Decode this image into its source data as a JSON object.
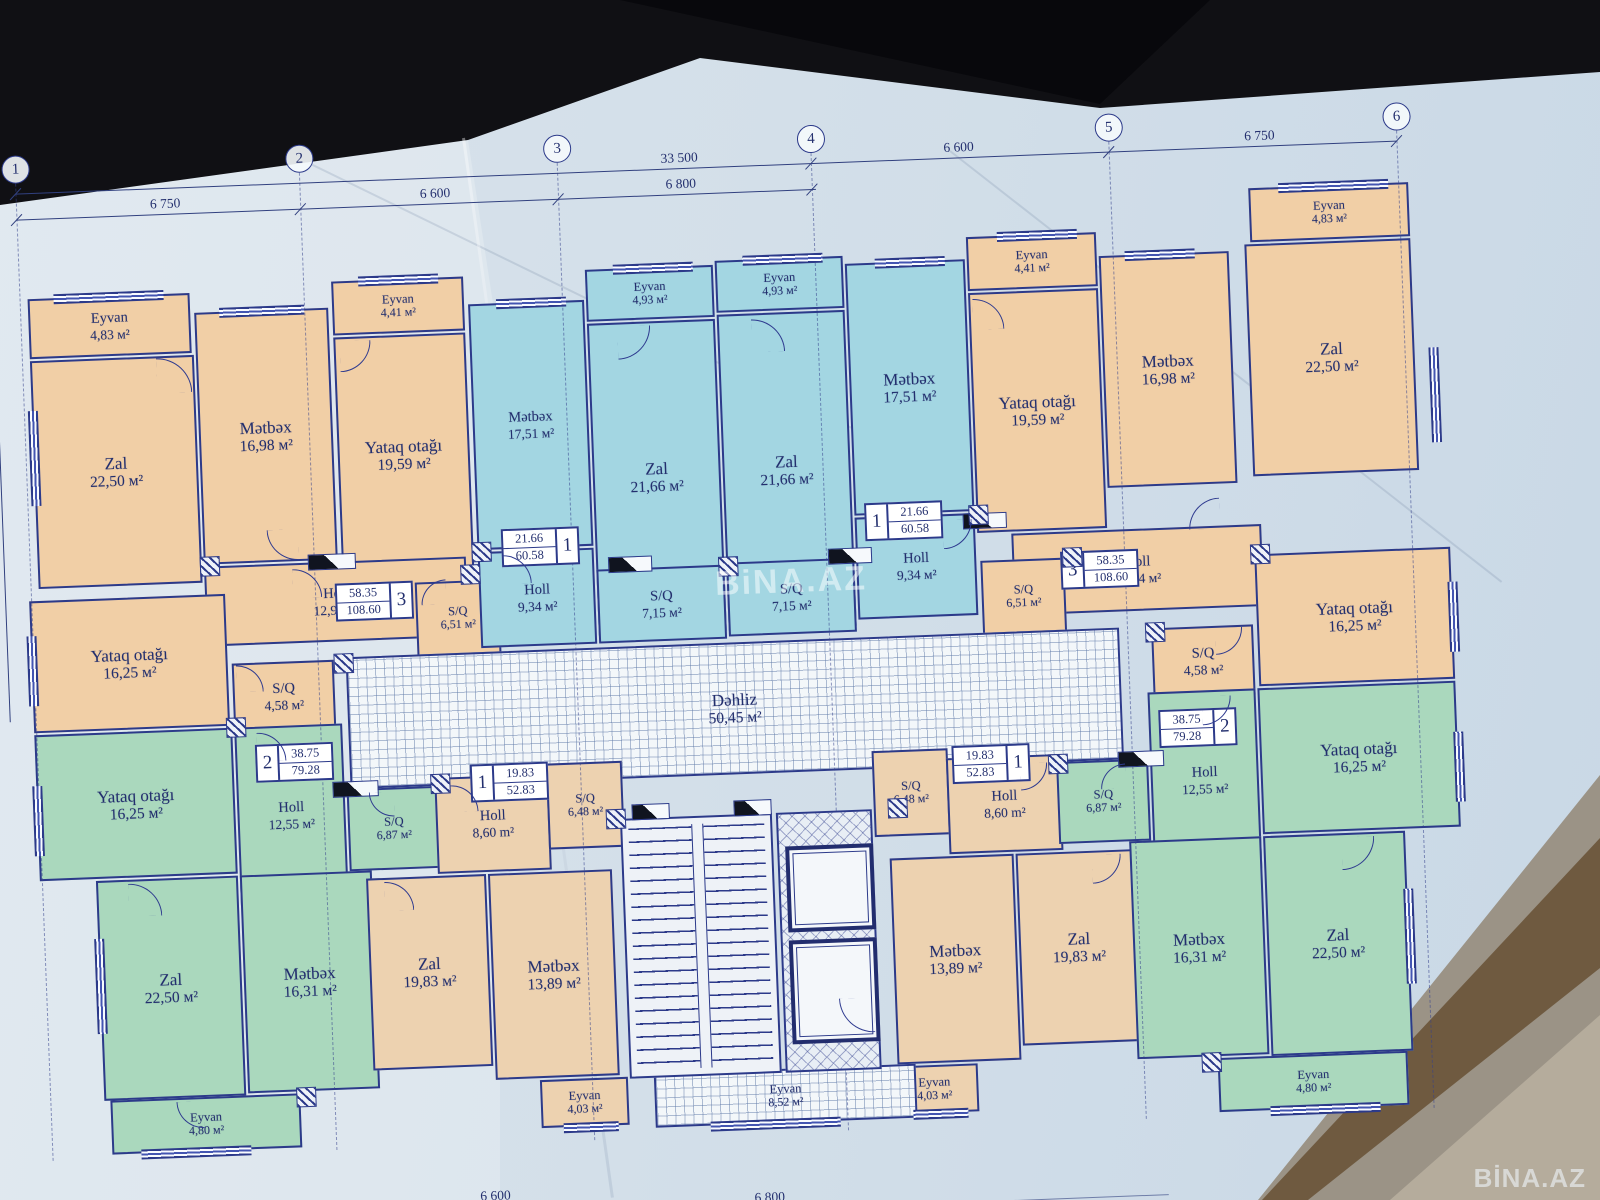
{
  "watermarks": {
    "center": "BiNA.AZ",
    "corner": "BİNA.AZ"
  },
  "axes": [
    {
      "n": "1",
      "x": 6
    },
    {
      "n": "2",
      "x": 290
    },
    {
      "n": "3",
      "x": 548
    },
    {
      "n": "4",
      "x": 802
    },
    {
      "n": "5",
      "x": 1100
    },
    {
      "n": "6",
      "x": 1388
    }
  ],
  "dimensions": {
    "upper": [
      {
        "t": "33 500",
        "x": 652
      },
      {
        "t": "6 600",
        "x": 935
      },
      {
        "t": "6 750",
        "x": 1236
      }
    ],
    "lower": [
      {
        "t": "6 750",
        "x": 140
      },
      {
        "t": "6 600",
        "x": 410
      },
      {
        "t": "6 800",
        "x": 656
      }
    ],
    "bottom": [
      {
        "t": "6 600",
        "x": 432
      },
      {
        "t": "6 800",
        "x": 706
      }
    ]
  },
  "rooms": [
    {
      "n": "Eyvan",
      "a": "4,83 м²",
      "x": 14,
      "y": 58,
      "w": 162,
      "h": 60,
      "f": "o"
    },
    {
      "n": "Zal",
      "a": "22,50 м²",
      "x": 14,
      "y": 120,
      "w": 164,
      "h": 228,
      "f": "o"
    },
    {
      "n": "Mətbəx",
      "a": "16,98 м²",
      "x": 180,
      "y": 78,
      "w": 134,
      "h": 252,
      "f": "o"
    },
    {
      "n": "Eyvan",
      "a": "4,41 м²",
      "x": 318,
      "y": 52,
      "w": 132,
      "h": 54,
      "f": "o"
    },
    {
      "n": "Yataq otağı",
      "a": "19,59 м²",
      "x": 318,
      "y": 108,
      "w": 132,
      "h": 240,
      "f": "o"
    },
    {
      "n": "Holl",
      "a": "12,94 м²",
      "x": 180,
      "y": 332,
      "w": 262,
      "h": 80,
      "f": "o"
    },
    {
      "n": "S/Q",
      "a": "6,51 м²",
      "x": 390,
      "y": 356,
      "w": 84,
      "h": 74,
      "f": "o"
    },
    {
      "n": "Yataq otağı",
      "a": "16,25 м²",
      "x": 4,
      "y": 360,
      "w": 196,
      "h": 132,
      "f": "o"
    },
    {
      "n": "S/Q",
      "a": "4,58 м²",
      "x": 204,
      "y": 430,
      "w": 102,
      "h": 70,
      "f": "o"
    },
    {
      "n": "Mətbəx",
      "a": "17,51 м²",
      "x": 454,
      "y": 80,
      "w": 116,
      "h": 246,
      "f": "b"
    },
    {
      "n": "Eyvan",
      "a": "4,93 м²",
      "x": 572,
      "y": 50,
      "w": 128,
      "h": 52,
      "f": "b"
    },
    {
      "n": "Zal",
      "a": "21,66 м²",
      "x": 572,
      "y": 104,
      "w": 128,
      "h": 312,
      "f": "b"
    },
    {
      "n": "Holl",
      "a": "9,34 м²",
      "x": 454,
      "y": 328,
      "w": 116,
      "h": 96,
      "f": "b"
    },
    {
      "n": "S/Q",
      "a": "7,15 м²",
      "x": 572,
      "y": 350,
      "w": 128,
      "h": 74,
      "f": "b"
    },
    {
      "n": "Eyvan",
      "a": "4,93 м²",
      "x": 702,
      "y": 46,
      "w": 128,
      "h": 52,
      "f": "b"
    },
    {
      "n": "Zal",
      "a": "21,66 м²",
      "x": 702,
      "y": 100,
      "w": 128,
      "h": 316,
      "f": "b"
    },
    {
      "n": "Mətbəx",
      "a": "17,51 м²",
      "x": 832,
      "y": 54,
      "w": 120,
      "h": 252,
      "f": "b"
    },
    {
      "n": "S/Q",
      "a": "7,15 м²",
      "x": 702,
      "y": 348,
      "w": 128,
      "h": 74,
      "f": "b"
    },
    {
      "n": "Holl",
      "a": "9,34 м²",
      "x": 832,
      "y": 308,
      "w": 120,
      "h": 102,
      "f": "b"
    },
    {
      "n": "Eyvan",
      "a": "4,41 м²",
      "x": 954,
      "y": 32,
      "w": 130,
      "h": 54,
      "f": "o"
    },
    {
      "n": "Yataq otağı",
      "a": "19,59 м²",
      "x": 954,
      "y": 88,
      "w": 130,
      "h": 240,
      "f": "o"
    },
    {
      "n": "Mətbəx",
      "a": "16,98 м²",
      "x": 1086,
      "y": 56,
      "w": 130,
      "h": 232,
      "f": "o"
    },
    {
      "n": "Zal",
      "a": "22,50 м²",
      "x": 1232,
      "y": 50,
      "w": 166,
      "h": 232,
      "f": "o"
    },
    {
      "n": "Eyvan",
      "a": "4,83 м²",
      "x": 1238,
      "y": -6,
      "w": 160,
      "h": 54,
      "f": "o"
    },
    {
      "n": "Holl",
      "a": "12,94 м²",
      "x": 988,
      "y": 330,
      "w": 250,
      "h": 82,
      "f": "o"
    },
    {
      "n": "S/Q",
      "a": "6,51 м²",
      "x": 956,
      "y": 356,
      "w": 84,
      "h": 74,
      "f": "o"
    },
    {
      "n": "S/Q",
      "a": "4,58 м²",
      "x": 1124,
      "y": 430,
      "w": 102,
      "h": 70,
      "f": "o"
    },
    {
      "n": "Yataq otağı",
      "a": "16,25 м²",
      "x": 1230,
      "y": 360,
      "w": 196,
      "h": 132,
      "f": "o"
    },
    {
      "n": "Dəhliz",
      "a": "50,45 м²",
      "x": 318,
      "y": 428,
      "w": 774,
      "h": 132,
      "f": "h"
    },
    {
      "n": "Yataq otağı",
      "a": "16,25 м²",
      "x": 4,
      "y": 494,
      "w": 198,
      "h": 146,
      "f": "g"
    },
    {
      "n": "Holl",
      "a": "12,55 м²",
      "x": 204,
      "y": 494,
      "w": 108,
      "h": 180,
      "f": "g"
    },
    {
      "n": "S/Q",
      "a": "6,87 м²",
      "x": 314,
      "y": 560,
      "w": 92,
      "h": 82,
      "f": "g"
    },
    {
      "n": "Zal",
      "a": "22,50 м²",
      "x": 60,
      "y": 642,
      "w": 142,
      "h": 220,
      "f": "g"
    },
    {
      "n": "Mətbəx",
      "a": "16,31 м²",
      "x": 204,
      "y": 642,
      "w": 132,
      "h": 218,
      "f": "g"
    },
    {
      "n": "Eyvan",
      "a": "4,80 м²",
      "x": 66,
      "y": 862,
      "w": 190,
      "h": 54,
      "f": "g"
    },
    {
      "n": "Holl",
      "a": "8,60 m²",
      "x": 402,
      "y": 552,
      "w": 114,
      "h": 96,
      "f": "t"
    },
    {
      "n": "S/Q",
      "a": "6,48 м²",
      "x": 514,
      "y": 542,
      "w": 76,
      "h": 86,
      "f": "t"
    },
    {
      "n": "Zal",
      "a": "19,83 м²",
      "x": 330,
      "y": 650,
      "w": 120,
      "h": 192,
      "f": "t"
    },
    {
      "n": "Mətbəx",
      "a": "13,89 м²",
      "x": 452,
      "y": 650,
      "w": 124,
      "h": 206,
      "f": "t"
    },
    {
      "n": "Eyvan",
      "a": "4,03 м²",
      "x": 496,
      "y": 858,
      "w": 88,
      "h": 48,
      "f": "t"
    },
    {
      "n": "S/Q",
      "a": "6,48 м²",
      "x": 840,
      "y": 542,
      "w": 76,
      "h": 86,
      "f": "t"
    },
    {
      "n": "Holl",
      "a": "8,60 m²",
      "x": 914,
      "y": 552,
      "w": 114,
      "h": 96,
      "f": "t"
    },
    {
      "n": "Mətbəx",
      "a": "13,89 м²",
      "x": 854,
      "y": 650,
      "w": 124,
      "h": 206,
      "f": "t"
    },
    {
      "n": "Zal",
      "a": "19,83 м²",
      "x": 980,
      "y": 650,
      "w": 120,
      "h": 192,
      "f": "t"
    },
    {
      "n": "Eyvan",
      "a": "4,03 м²",
      "x": 846,
      "y": 858,
      "w": 88,
      "h": 48,
      "f": "t"
    },
    {
      "n": "Yataq otağı",
      "a": "16,25 м²",
      "x": 1228,
      "y": 494,
      "w": 198,
      "h": 146,
      "f": "g"
    },
    {
      "n": "Holl",
      "a": "12,55 м²",
      "x": 1118,
      "y": 494,
      "w": 108,
      "h": 180,
      "f": "g"
    },
    {
      "n": "S/Q",
      "a": "6,87 м²",
      "x": 1024,
      "y": 560,
      "w": 92,
      "h": 82,
      "f": "g"
    },
    {
      "n": "Mətbəx",
      "a": "16,31 м²",
      "x": 1094,
      "y": 642,
      "w": 132,
      "h": 218,
      "f": "g"
    },
    {
      "n": "Zal",
      "a": "22,50 м²",
      "x": 1228,
      "y": 642,
      "w": 142,
      "h": 220,
      "f": "g"
    },
    {
      "n": "Eyvan",
      "a": "4,80 м²",
      "x": 1174,
      "y": 862,
      "w": 190,
      "h": 54,
      "f": "g"
    },
    {
      "n": "Eyvan",
      "a": "8,52 м²",
      "x": 610,
      "y": 856,
      "w": 262,
      "h": 54,
      "f": "h"
    }
  ],
  "tags": [
    {
      "d": "3",
      "t": "58.35",
      "b": "108.60",
      "s": "r",
      "x": 310,
      "y": 354
    },
    {
      "d": "1",
      "t": "21.66",
      "b": "60.58",
      "s": "r",
      "x": 478,
      "y": 306
    },
    {
      "d": "1",
      "t": "21.66",
      "b": "60.58",
      "s": "l",
      "x": 842,
      "y": 294
    },
    {
      "d": "3",
      "t": "58.35",
      "b": "108.60",
      "s": "l",
      "x": 1036,
      "y": 350
    },
    {
      "d": "2",
      "t": "38.75",
      "b": "79.28",
      "s": "l",
      "x": 224,
      "y": 512
    },
    {
      "d": "2",
      "t": "38.75",
      "b": "79.28",
      "s": "r",
      "x": 1128,
      "y": 512
    },
    {
      "d": "1",
      "t": "19.83",
      "b": "52.83",
      "s": "l",
      "x": 438,
      "y": 540
    },
    {
      "d": "1",
      "t": "19.83",
      "b": "52.83",
      "s": "r",
      "x": 920,
      "y": 540
    }
  ]
}
